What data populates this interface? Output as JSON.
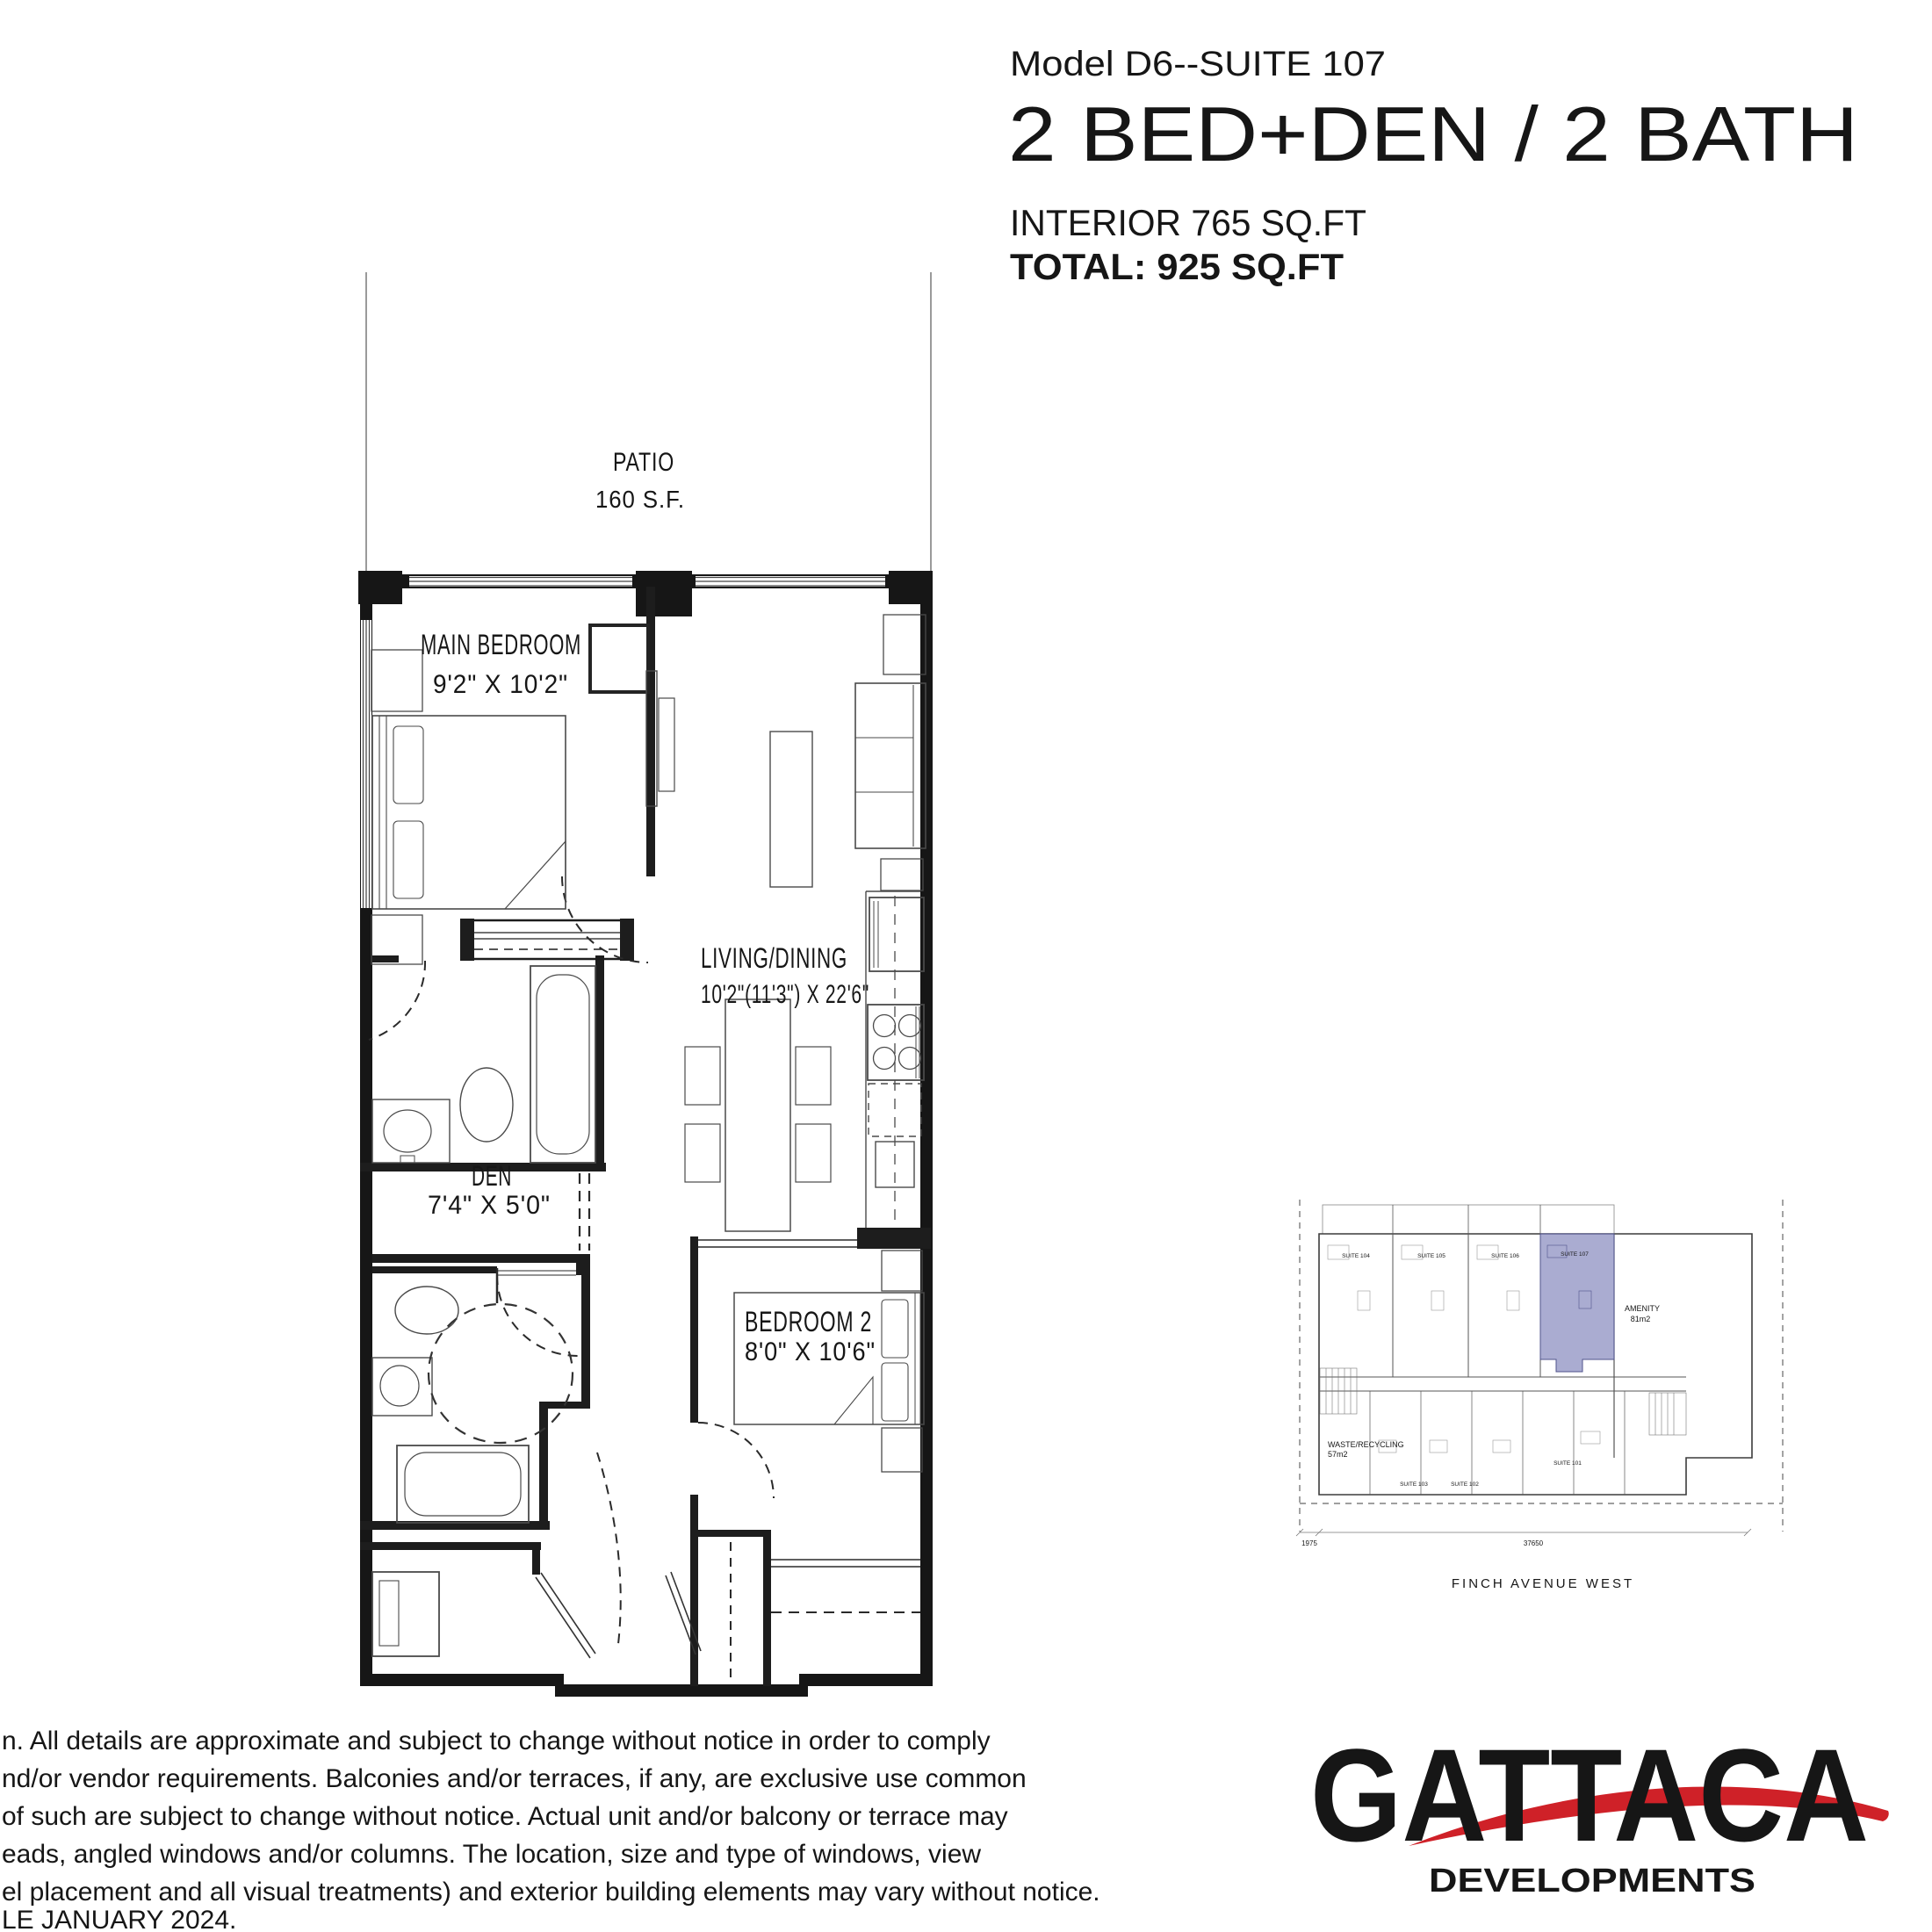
{
  "header": {
    "model": "Model D6--SUITE 107",
    "title": "2 BED+DEN / 2 BATH",
    "interior": "INTERIOR 765 SQ.FT",
    "total": "TOTAL: 925 SQ.FT"
  },
  "plan": {
    "patio_label": "PATIO",
    "patio_area": "160 S.F.",
    "rooms": {
      "main_bedroom": {
        "name": "MAIN BEDROOM",
        "dims": "9'2\" X 10'2\""
      },
      "living_dining": {
        "name": "LIVING/DINING",
        "dims": "10'2\"(11'3\") X 22'6\""
      },
      "den": {
        "name": "DEN",
        "dims": "7'4\" X 5'0\""
      },
      "bedroom2": {
        "name": "BEDROOM 2",
        "dims": "8'0\" X 10'6\""
      }
    }
  },
  "keyplan": {
    "amenity_label": "AMENITY",
    "amenity_area": "81m2",
    "waste_label": "WASTE/RECYCLING",
    "waste_area": "57m2",
    "street": "FINCH AVENUE WEST",
    "dim_total": "37650",
    "dim_left": "1975",
    "suites_top": [
      "SUITE 104",
      "SUITE 105",
      "SUITE 106",
      "SUITE 107"
    ],
    "suites_bottom": [
      "SUITE 103",
      "SUITE 102",
      "SUITE 101"
    ],
    "highlight_color": "#9b9ec9"
  },
  "disclaimer": {
    "lines": [
      "n. All details are approximate and subject to change without notice in order to comply",
      "nd/or vendor requirements. Balconies and/or terraces, if any, are exclusive use common",
      "of such are subject to change without notice.  Actual unit and/or balcony or terrace may",
      "eads, angled windows and/or columns.  The location, size and type of windows, view",
      "el placement and all visual treatments) and exterior building elements may vary without notice.",
      "LE JANUARY 2024."
    ]
  },
  "logo": {
    "name": "GATTACA",
    "tagline": "DEVELOPMENTS",
    "red": "#cf2128",
    "dark": "#3e4347"
  }
}
